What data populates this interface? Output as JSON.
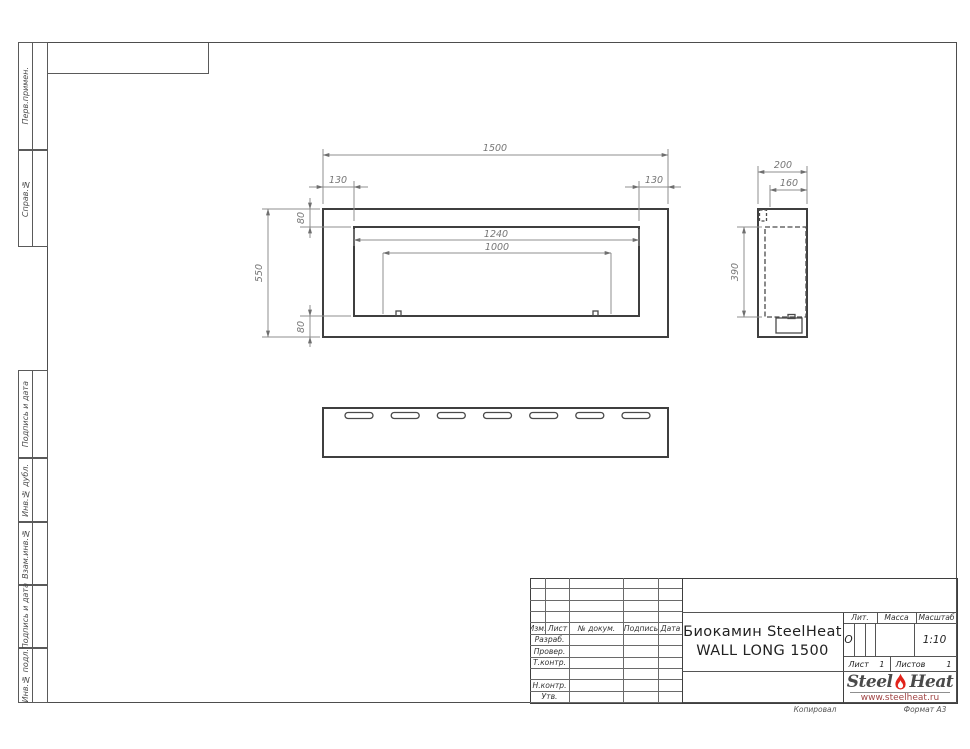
{
  "colors": {
    "brand_red": "#e2231a",
    "line_dark": "#4a4a4a",
    "line_thin": "#8f8f8f",
    "dim_text": "#767676",
    "logo_url_red": "#a04545"
  },
  "side_column": {
    "labels": [
      {
        "label": "Перв.примен."
      },
      {
        "label": "Справ.№"
      },
      {
        "label": "Подпись и дата"
      },
      {
        "label": "Инв.№ дубл."
      },
      {
        "label": "Взам.инв.№"
      },
      {
        "label": "Подпись и дата"
      },
      {
        "label": "Инв.№ подл."
      }
    ]
  },
  "drawing": {
    "front": {
      "width": "1500",
      "margin_left": "130",
      "margin_right": "130",
      "margin_top": "80",
      "height": "550",
      "margin_bottom": "80",
      "opening_width": "1240",
      "burner_width": "1000"
    },
    "side": {
      "depth": "200",
      "inner_depth": "160",
      "opening_height": "390"
    }
  },
  "title_block": {
    "revision_headers": [
      "Изм.",
      "Лист",
      "№ докум.",
      "Подпись",
      "Дата"
    ],
    "signature_rows": [
      "Разраб.",
      "Провер.",
      "Т.контр.",
      "Н.контр.",
      "Утв."
    ],
    "doc_title_line1": "Биокамин SteelHeat",
    "doc_title_line2": "WALL LONG 1500",
    "lit_label": "Лит.",
    "lit_value": "О",
    "mass_label": "Масса",
    "mass_value": "",
    "scale_label": "Масштаб",
    "scale_value": "1:10",
    "sheet_label": "Лист",
    "sheet_value": "1",
    "sheets_label": "Листов",
    "sheets_value": "1",
    "logo_steel": "Steel",
    "logo_heat": "Heat",
    "logo_url": "www.steelheat.ru"
  },
  "footer": {
    "copied": "Копировал",
    "format": "Формат А3"
  }
}
